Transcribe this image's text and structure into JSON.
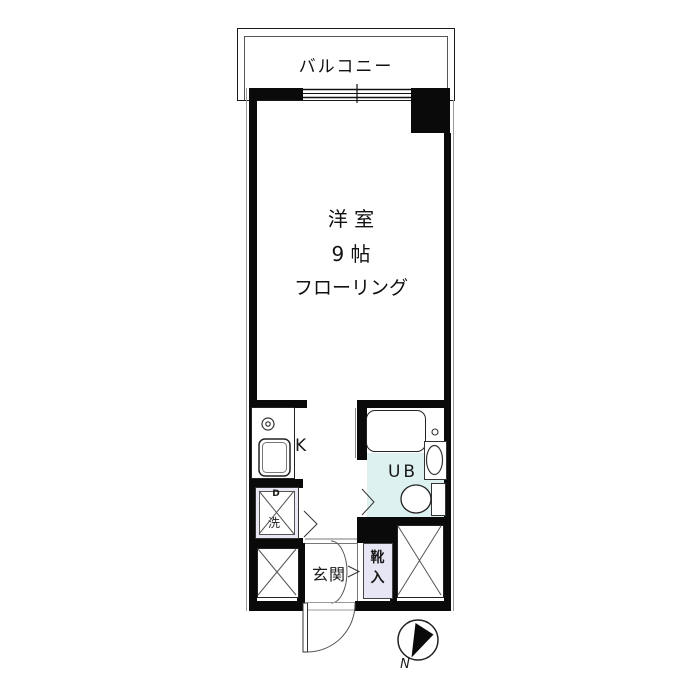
{
  "floorplan": {
    "balcony": {
      "label": "バルコニー"
    },
    "room": {
      "name": "洋 室",
      "size": "9 帖",
      "floor_type": "フローリング"
    },
    "kitchen": {
      "label": "K"
    },
    "washer_space": {
      "top_label": "D",
      "label": "洗"
    },
    "unit_bath": {
      "label": "UB"
    },
    "entrance": {
      "label": "玄関"
    },
    "shoe_cabinet": {
      "char1": "靴",
      "char2": "入"
    },
    "compass": {
      "label": "N"
    },
    "colors": {
      "wall": "#0a0a0a",
      "unit_bath_fill": "#ddf1f1",
      "shoe_cabinet_fill": "#e7e6f5",
      "washer_fill": "#e9e8f4",
      "line": "#555555"
    }
  }
}
